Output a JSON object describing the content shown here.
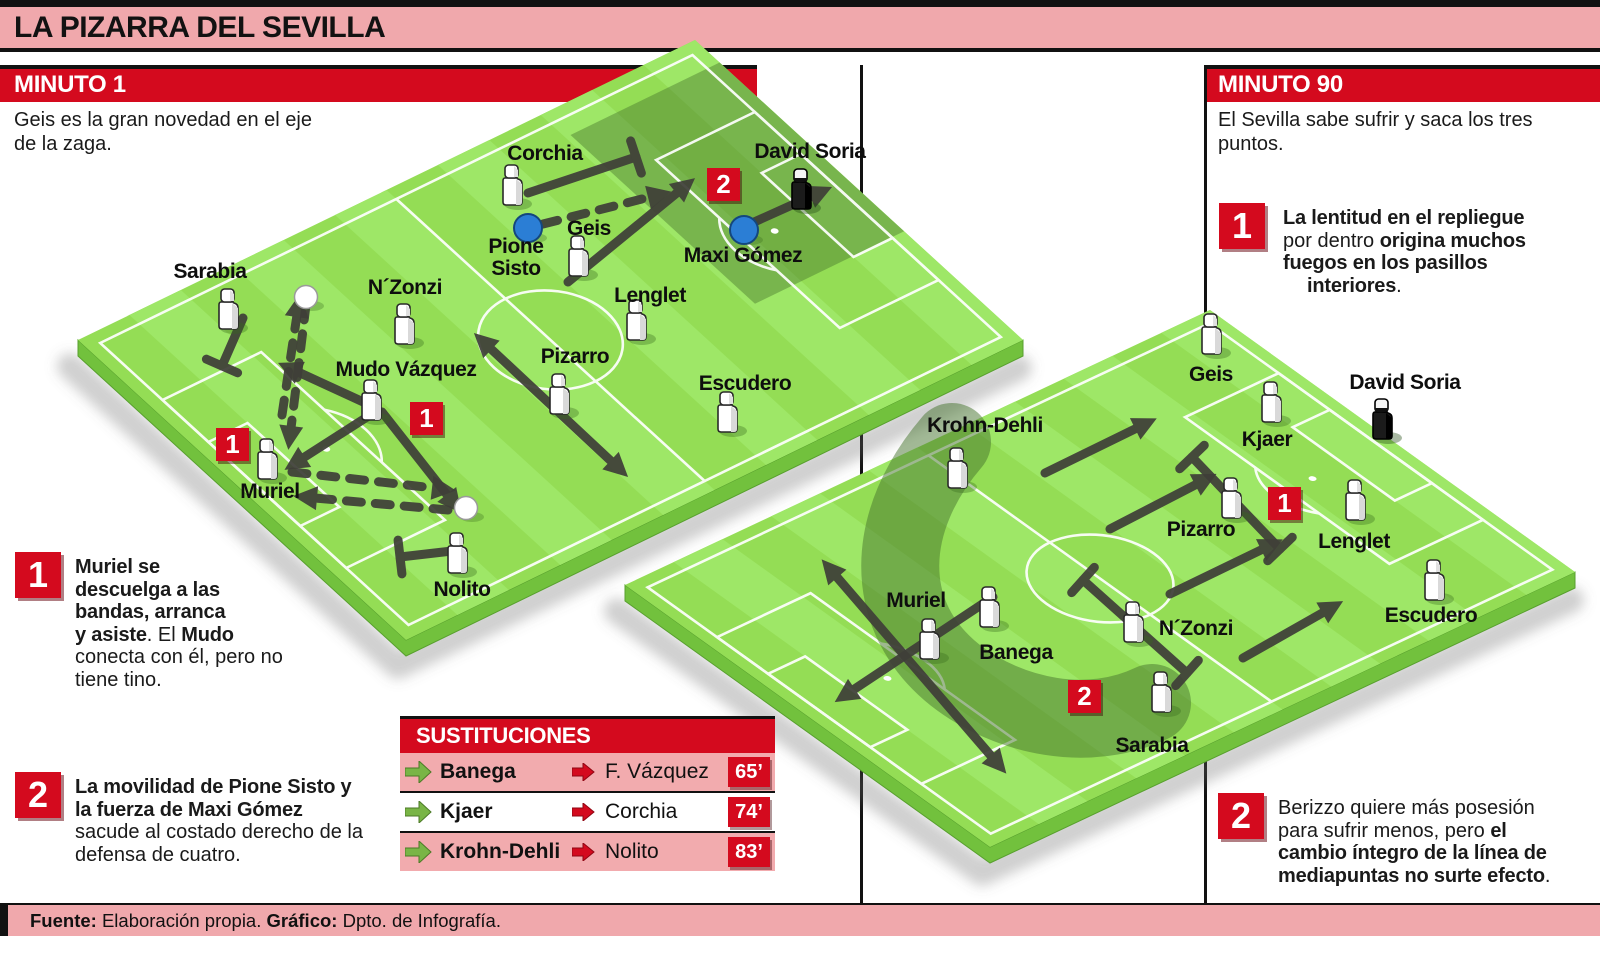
{
  "page": {
    "title": "LA PIZARRA DEL SEVILLA"
  },
  "colors": {
    "accent_red": "#d40a1e",
    "panel_pink": "#f0a8ac",
    "row_pink": "#f2abae",
    "sub_green": "#79b546",
    "arrow_dark": "#3f3f38",
    "pitch_base": "#94dd55",
    "pitch_stripe": "#9ee767",
    "pitch_side": "#72c13d",
    "zone_dark": "rgba(62,108,40,0.40)",
    "opponent_blue": "#2b7ed5",
    "line_white": "#ffffff"
  },
  "minuto1": {
    "header": "MINUTO 1",
    "intro_lines": [
      "Geis es la gran novedad en el eje",
      "de la zaga."
    ]
  },
  "minuto90": {
    "header": "MINUTO 90",
    "intro_lines": [
      "El Sevilla sabe sufrir y saca los tres",
      "puntos."
    ]
  },
  "notes": {
    "left1": {
      "num": "1",
      "lines": [
        [
          {
            "t": "Muriel se",
            "b": 1
          }
        ],
        [
          {
            "t": "descuelga a las",
            "b": 1
          }
        ],
        [
          {
            "t": "bandas, arranca",
            "b": 1
          }
        ],
        [
          {
            "t": "y asiste",
            "b": 1
          },
          {
            "t": ". El ",
            "b": 0
          },
          {
            "t": "Mudo",
            "b": 1
          }
        ],
        [
          {
            "t": "conecta con él, pero no",
            "b": 0
          }
        ],
        [
          {
            "t": "tiene tino.",
            "b": 0
          }
        ]
      ]
    },
    "left2": {
      "num": "2",
      "lines": [
        [
          {
            "t": "La movilidad de Pione Sisto y",
            "b": 1
          }
        ],
        [
          {
            "t": "la fuerza de Maxi Gómez",
            "b": 1
          }
        ],
        [
          {
            "t": "sacude al costado derecho de la",
            "b": 0
          }
        ],
        [
          {
            "t": "defensa de cuatro.",
            "b": 0
          }
        ]
      ]
    },
    "right1": {
      "num": "1",
      "indent_last": 24,
      "lines": [
        [
          {
            "t": "La lentitud en el repliegue",
            "b": 1
          }
        ],
        [
          {
            "t": "por dentro ",
            "b": 0
          },
          {
            "t": "origina muchos",
            "b": 1
          }
        ],
        [
          {
            "t": "fuegos en los pasillos",
            "b": 1
          }
        ],
        [
          {
            "t": "interiores",
            "b": 1
          },
          {
            "t": ".",
            "b": 0
          }
        ]
      ]
    },
    "right2": {
      "num": "2",
      "lines": [
        [
          {
            "t": "Berizzo quiere más posesión",
            "b": 0
          }
        ],
        [
          {
            "t": "para sufrir menos, pero ",
            "b": 0
          },
          {
            "t": "el",
            "b": 1
          }
        ],
        [
          {
            "t": "cambio íntegro de la línea de",
            "b": 1
          }
        ],
        [
          {
            "t": "mediapuntas no surte efecto",
            "b": 1
          },
          {
            "t": ".",
            "b": 0
          }
        ]
      ]
    }
  },
  "substitutions": {
    "header": "SUSTITUCIONES",
    "rows": [
      {
        "out": "Banega",
        "in": "F. Vázquez",
        "minute": "65’"
      },
      {
        "out": "Kjaer",
        "in": "Corchia",
        "minute": "74’"
      },
      {
        "out": "Krohn-Dehli",
        "in": "Nolito",
        "minute": "83’"
      }
    ]
  },
  "footer": {
    "segments": [
      {
        "t": "Fuente:",
        "b": 1
      },
      {
        "t": " Elaboración propia. ",
        "b": 0
      },
      {
        "t": "Gráfico:",
        "b": 1
      },
      {
        "t": " Dpto. de Infografía.",
        "b": 0
      }
    ]
  },
  "pitches": [
    {
      "name": "pitch-minuto-1",
      "corners": {
        "L": [
          78,
          340
        ],
        "T": [
          695,
          40
        ],
        "R": [
          1023,
          340
        ],
        "B": [
          406,
          640
        ]
      },
      "zones": [
        [
          455,
          30,
          145,
          225
        ]
      ],
      "band": null,
      "figures": [
        {
          "n": "Corchia",
          "x": 512,
          "y": 187
        },
        {
          "n": "Geis",
          "x": 578,
          "y": 258
        },
        {
          "n": "Lenglet",
          "x": 636,
          "y": 322
        },
        {
          "n": "Sarabia",
          "x": 228,
          "y": 311
        },
        {
          "n": "N´Zonzi",
          "x": 404,
          "y": 326
        },
        {
          "n": "Mudo Vázquez",
          "x": 371,
          "y": 402
        },
        {
          "n": "Pizarro",
          "x": 559,
          "y": 396
        },
        {
          "n": "Escudero",
          "x": 727,
          "y": 414
        },
        {
          "n": "Muriel",
          "x": 267,
          "y": 461
        },
        {
          "n": "Nolito",
          "x": 457,
          "y": 555
        },
        {
          "n": "David Soria",
          "x": 801,
          "y": 191,
          "gk": 1
        }
      ],
      "dots": [
        [
          528,
          228
        ],
        [
          744,
          230
        ]
      ],
      "balls": [
        [
          306,
          297
        ],
        [
          466,
          508
        ]
      ],
      "markers": [
        {
          "num": "1",
          "x": 216,
          "y": 428
        },
        {
          "num": "1",
          "x": 410,
          "y": 402
        },
        {
          "num": "2",
          "x": 707,
          "y": 168
        }
      ],
      "labels": [
        {
          "t": "Corchia",
          "x": 545,
          "y": 154
        },
        {
          "t": "David Soria",
          "x": 810,
          "y": 152
        },
        {
          "t": "Pione\nSisto",
          "x": 516,
          "y": 258
        },
        {
          "t": "Geis",
          "x": 589,
          "y": 229
        },
        {
          "t": "Maxi Gómez",
          "x": 743,
          "y": 256
        },
        {
          "t": "Lenglet",
          "x": 650,
          "y": 296
        },
        {
          "t": "Sarabia",
          "x": 210,
          "y": 272
        },
        {
          "t": "N´Zonzi",
          "x": 405,
          "y": 288
        },
        {
          "t": "Mudo Vázquez",
          "x": 406,
          "y": 370
        },
        {
          "t": "Pizarro",
          "x": 575,
          "y": 357
        },
        {
          "t": "Escudero",
          "x": 745,
          "y": 384
        },
        {
          "t": "Muriel",
          "x": 270,
          "y": 492
        },
        {
          "t": "Nolito",
          "x": 462,
          "y": 590
        }
      ],
      "arrows": [
        {
          "x1": 528,
          "y1": 193,
          "x2": 636,
          "y2": 157,
          "end": "bar"
        },
        {
          "x1": 568,
          "y1": 282,
          "x2": 678,
          "y2": 192,
          "end": "arrow"
        },
        {
          "x1": 543,
          "y1": 224,
          "x2": 650,
          "y2": 197,
          "end": "arrow",
          "dash": 1
        },
        {
          "x1": 752,
          "y1": 223,
          "x2": 812,
          "y2": 196,
          "end": "arrow"
        },
        {
          "x1": 243,
          "y1": 318,
          "x2": 222,
          "y2": 366,
          "end": "bar"
        },
        {
          "x1": 306,
          "y1": 305,
          "x2": 291,
          "y2": 428,
          "end": "arrow",
          "dash": 1
        },
        {
          "x1": 282,
          "y1": 415,
          "x2": 297,
          "y2": 315,
          "end": "arrow",
          "dash": 1
        },
        {
          "x1": 372,
          "y1": 406,
          "x2": 298,
          "y2": 372,
          "end": "arrow"
        },
        {
          "x1": 378,
          "y1": 410,
          "x2": 303,
          "y2": 458,
          "end": "arrow"
        },
        {
          "x1": 382,
          "y1": 412,
          "x2": 448,
          "y2": 496,
          "end": "arrow"
        },
        {
          "x1": 292,
          "y1": 472,
          "x2": 434,
          "y2": 488,
          "end": "arrow",
          "dash": 1
        },
        {
          "x1": 448,
          "y1": 510,
          "x2": 315,
          "y2": 498,
          "end": "arrow",
          "dash": 1
        },
        {
          "x1": 490,
          "y1": 348,
          "x2": 612,
          "y2": 462,
          "end": "arrow",
          "start": "arrow"
        },
        {
          "x1": 452,
          "y1": 551,
          "x2": 400,
          "y2": 557,
          "end": "bar"
        }
      ]
    },
    {
      "name": "pitch-minuto-90",
      "corners": {
        "L": [
          625,
          585
        ],
        "T": [
          1210,
          310
        ],
        "R": [
          1575,
          572
        ],
        "B": [
          990,
          847
        ]
      },
      "zones": [],
      "band": "M 952 442 C 885 520 880 615 955 675 C 1010 718 1090 733 1152 703",
      "figures": [
        {
          "n": "Krohn-Dehli",
          "x": 957,
          "y": 470
        },
        {
          "n": "Geis",
          "x": 1211,
          "y": 336
        },
        {
          "n": "Kjaer",
          "x": 1271,
          "y": 404
        },
        {
          "n": "Pizarro",
          "x": 1231,
          "y": 500
        },
        {
          "n": "Lenglet",
          "x": 1355,
          "y": 502
        },
        {
          "n": "Escudero",
          "x": 1434,
          "y": 582
        },
        {
          "n": "Muriel",
          "x": 929,
          "y": 641
        },
        {
          "n": "Banega",
          "x": 989,
          "y": 609
        },
        {
          "n": "N´Zonzi",
          "x": 1133,
          "y": 624
        },
        {
          "n": "Sarabia",
          "x": 1161,
          "y": 694
        },
        {
          "n": "David Soria",
          "x": 1382,
          "y": 421,
          "gk": 1
        }
      ],
      "dots": [],
      "balls": [],
      "markers": [
        {
          "num": "1",
          "x": 1268,
          "y": 487
        },
        {
          "num": "2",
          "x": 1068,
          "y": 680
        }
      ],
      "labels": [
        {
          "t": "Krohn-Dehli",
          "x": 985,
          "y": 426
        },
        {
          "t": "Geis",
          "x": 1211,
          "y": 375
        },
        {
          "t": "Kjaer",
          "x": 1267,
          "y": 440
        },
        {
          "t": "David Soria",
          "x": 1405,
          "y": 383
        },
        {
          "t": "Pizarro",
          "x": 1201,
          "y": 530
        },
        {
          "t": "Lenglet",
          "x": 1354,
          "y": 542
        },
        {
          "t": "Escudero",
          "x": 1431,
          "y": 616
        },
        {
          "t": "Muriel",
          "x": 916,
          "y": 601
        },
        {
          "t": "Banega",
          "x": 1016,
          "y": 653
        },
        {
          "t": "N´Zonzi",
          "x": 1196,
          "y": 629
        },
        {
          "t": "Sarabia",
          "x": 1152,
          "y": 746
        }
      ],
      "arrows": [
        {
          "x1": 1045,
          "y1": 473,
          "x2": 1137,
          "y2": 428,
          "end": "arrow"
        },
        {
          "x1": 1110,
          "y1": 529,
          "x2": 1197,
          "y2": 484,
          "end": "arrow"
        },
        {
          "x1": 1192,
          "y1": 457,
          "x2": 1280,
          "y2": 549,
          "end": "bar",
          "start": "bar"
        },
        {
          "x1": 1170,
          "y1": 594,
          "x2": 1263,
          "y2": 549,
          "end": "arrow"
        },
        {
          "x1": 1083,
          "y1": 580,
          "x2": 1187,
          "y2": 673,
          "end": "bar",
          "start": "bar"
        },
        {
          "x1": 1243,
          "y1": 658,
          "x2": 1324,
          "y2": 612,
          "end": "arrow"
        },
        {
          "x1": 836,
          "y1": 576,
          "x2": 992,
          "y2": 757,
          "end": "arrow",
          "start": "arrow"
        },
        {
          "x1": 993,
          "y1": 597,
          "x2": 853,
          "y2": 690,
          "end": "arrow"
        }
      ]
    }
  ]
}
